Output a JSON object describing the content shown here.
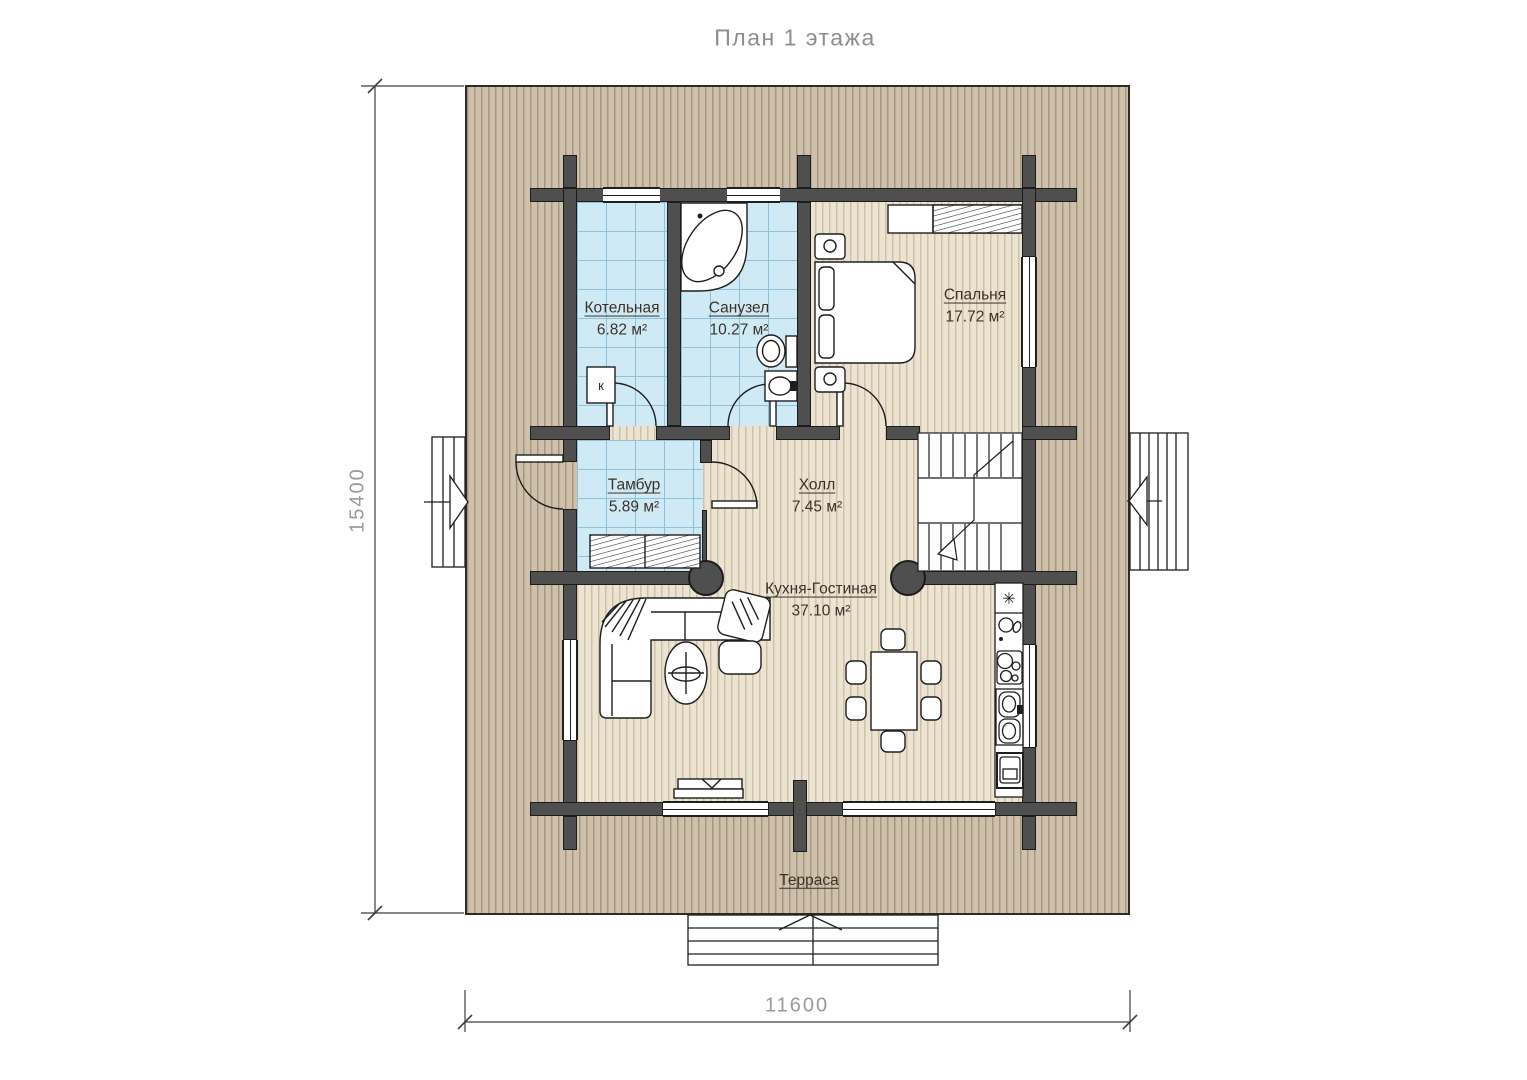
{
  "title": "План 1 этажа",
  "dimensions": {
    "vertical": "15400",
    "horizontal": "11600"
  },
  "rooms": {
    "boiler": {
      "name": "Котельная",
      "area": "6.82 м²"
    },
    "bathroom": {
      "name": "Санузел",
      "area": "10.27 м²"
    },
    "bedroom": {
      "name": "Спальня",
      "area": "17.72 м²"
    },
    "vestibule": {
      "name": "Тамбур",
      "area": "5.89 м²"
    },
    "hall": {
      "name": "Холл",
      "area": "7.45 м²"
    },
    "kitchen_living": {
      "name": "Кухня-Гостиная",
      "area": "37.10 м²"
    },
    "terrace": {
      "name": "Терраса"
    }
  },
  "symbols": {
    "boiler_unit": "к",
    "fridge": "✳"
  },
  "colors": {
    "wall": "#4f4f4f",
    "deck": "#cec0aa",
    "floor": "#ece3d1",
    "tile": "#cfe9f5",
    "tile_grid": "#8fc2da",
    "label_text": "#3b332a",
    "dim_text": "#9a9a9a"
  }
}
